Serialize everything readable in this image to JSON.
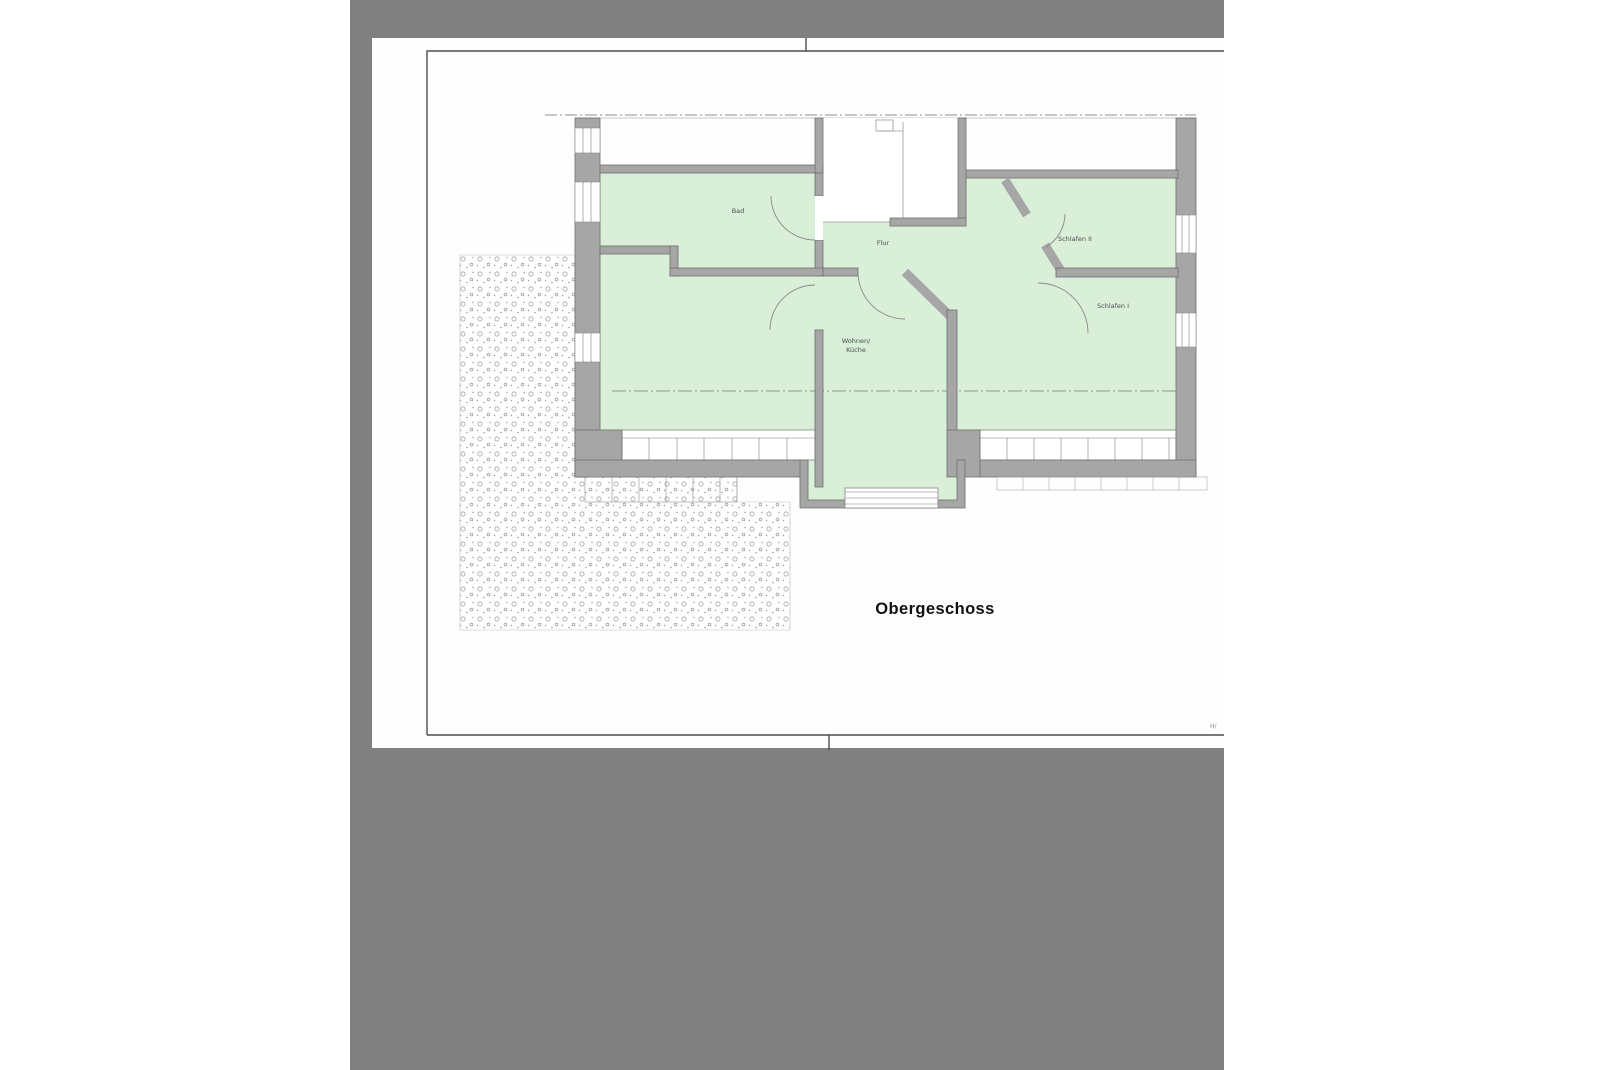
{
  "viewer": {
    "background_color": "#808080",
    "page_color": "#ffffff"
  },
  "plan": {
    "title": "Obergeschoss",
    "labels": {
      "bad": "Bad",
      "flur": "Flur",
      "schlafen2": "Schlafen II",
      "schlafen1": "Schlafen I",
      "wohnen_line1": "Wohnen/",
      "wohnen_line2": "Küche"
    },
    "corner_mark": "H/",
    "colors": {
      "room_fill": "#d9efd8",
      "wall_fill": "#a6a6a6",
      "wall_stroke": "#6f6f6f",
      "drawing_line": "#8a8a8a",
      "terrace_dot": "#9a9a9a"
    }
  }
}
